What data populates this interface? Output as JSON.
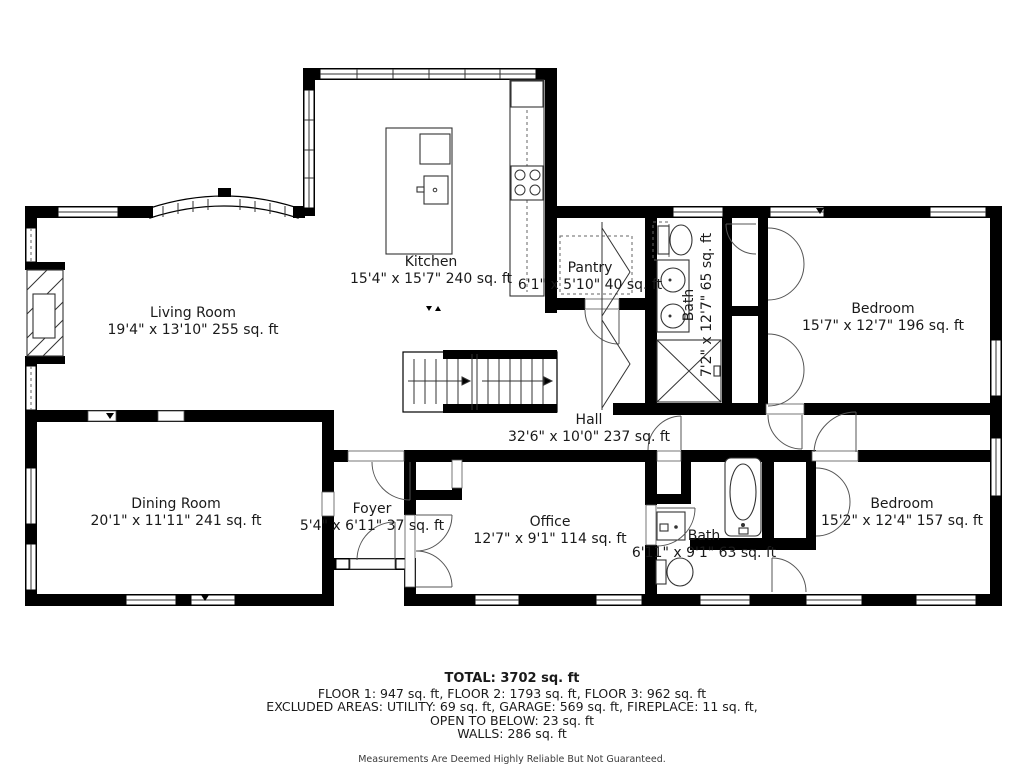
{
  "rooms": {
    "kitchen": {
      "name": "Kitchen",
      "dims": "15'4\" x 15'7\" 240 sq. ft"
    },
    "pantry": {
      "name": "Pantry",
      "dims": "6'1\" x 5'10\" 40 sq. ft"
    },
    "bath_upper": {
      "name": "Bath",
      "dims": "7'2\" x 12'7\" 65 sq. ft"
    },
    "bedroom_upper": {
      "name": "Bedroom",
      "dims": "15'7\" x 12'7\" 196 sq. ft"
    },
    "living_room": {
      "name": "Living Room",
      "dims": "19'4\" x 13'10\" 255 sq. ft"
    },
    "hall": {
      "name": "Hall",
      "dims": "32'6\" x 10'0\" 237 sq. ft"
    },
    "dining_room": {
      "name": "Dining Room",
      "dims": "20'1\" x 11'11\" 241 sq. ft"
    },
    "foyer": {
      "name": "Foyer",
      "dims": "5'4\" x 6'11\" 37 sq. ft"
    },
    "office": {
      "name": "Office",
      "dims": "12'7\" x 9'1\" 114 sq. ft"
    },
    "bath_lower": {
      "name": "Bath",
      "dims": "6'11\" x 9'1\" 63 sq. ft"
    },
    "bedroom_lower": {
      "name": "Bedroom",
      "dims": "15'2\" x 12'4\" 157 sq. ft"
    }
  },
  "summary": {
    "total": "TOTAL: 3702 sq. ft",
    "floors": "FLOOR 1: 947 sq. ft, FLOOR 2: 1793 sq. ft, FLOOR 3: 962 sq. ft",
    "excluded": "EXCLUDED AREAS: UTILITY: 69 sq. ft, GARAGE: 569 sq. ft, FIREPLACE: 11 sq. ft,",
    "open_below": "OPEN TO BELOW: 23 sq. ft",
    "walls": "WALLS: 286 sq. ft",
    "disclaimer": "Measurements Are Deemed Highly Reliable But Not Guaranteed."
  },
  "colors": {
    "wall": "#000000",
    "background": "#ffffff",
    "label": "#1a1a1a",
    "disclaimer": "#3a3a3a"
  }
}
